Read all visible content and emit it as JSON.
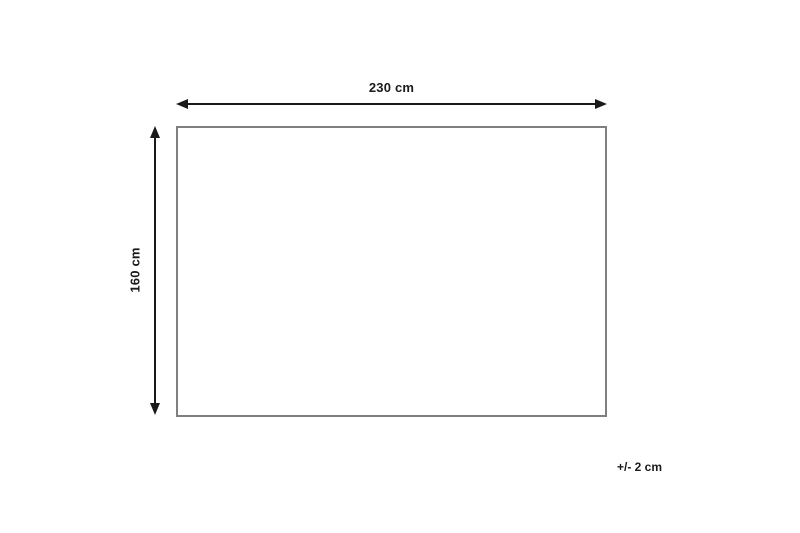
{
  "diagram": {
    "type": "product-dimension-diagram",
    "width_label": "230 cm",
    "height_label": "160 cm",
    "tolerance_label": "+/- 2 cm",
    "colors": {
      "arrow": "#1a1a1a",
      "text": "#1a1a1a",
      "outline": "#7f7f7f",
      "background": "#ffffff"
    }
  }
}
